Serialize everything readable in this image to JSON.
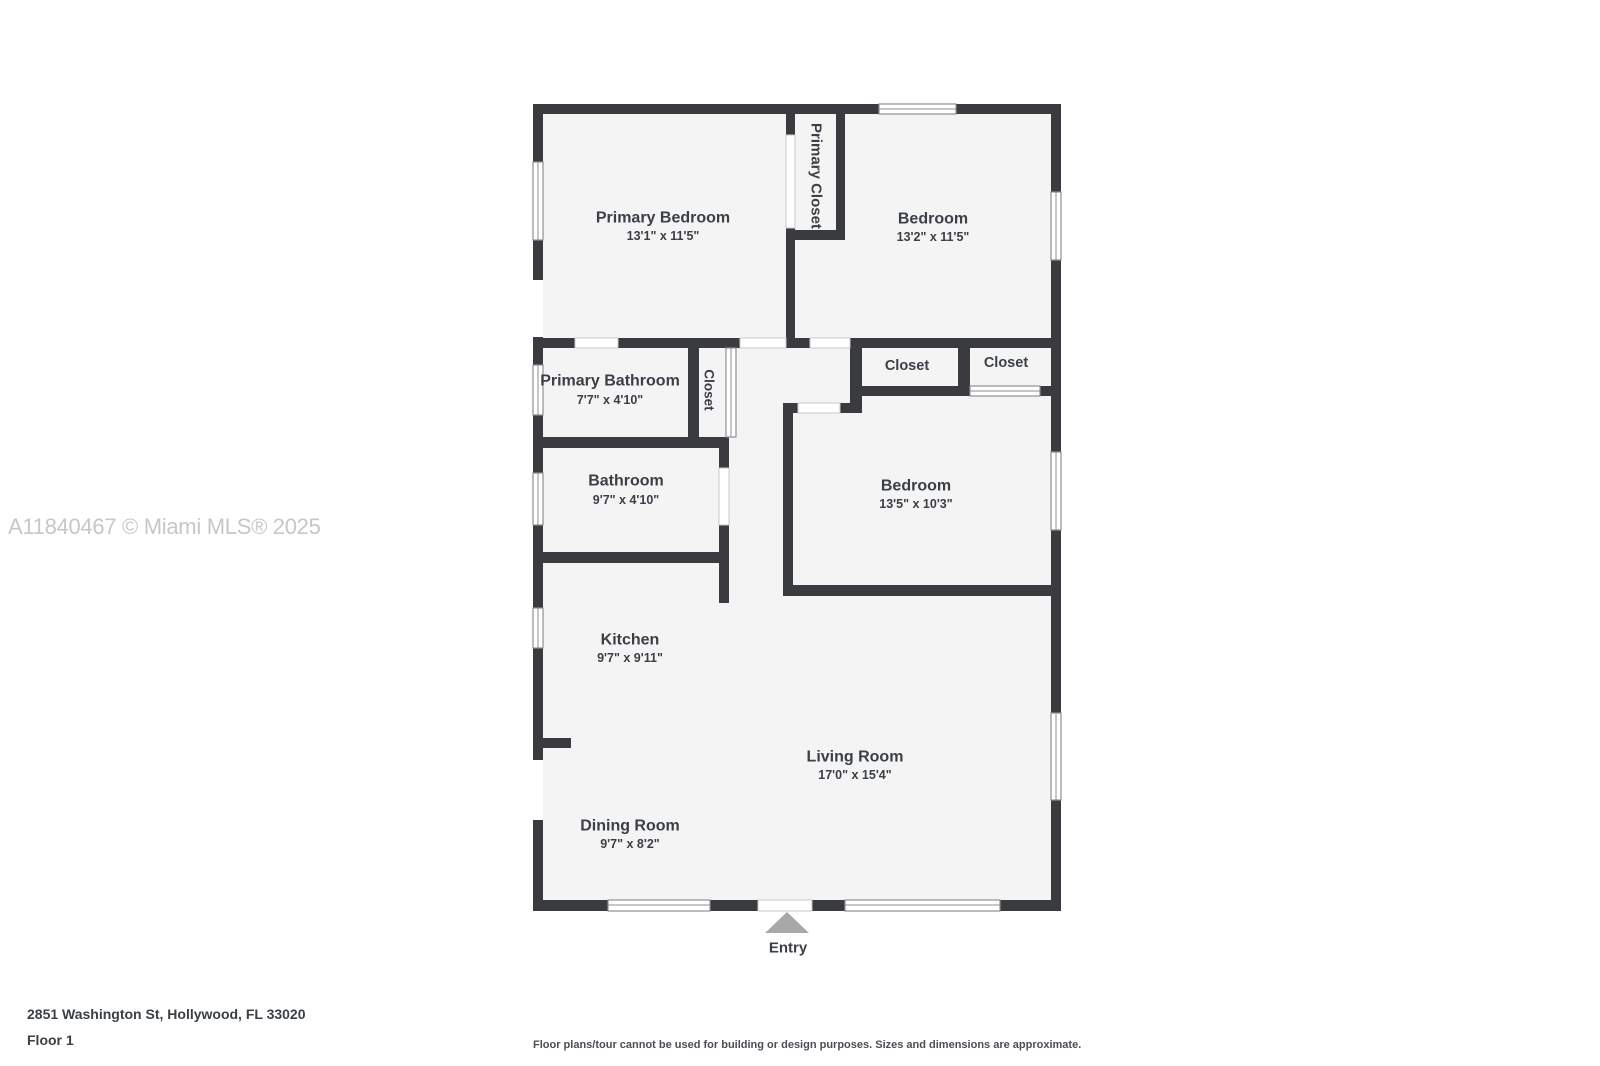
{
  "watermark": "A11840467 © Miami MLS® 2025",
  "entry_label": "Entry",
  "footer": {
    "address": "2851 Washington St, Hollywood, FL 33020",
    "floor": "Floor 1",
    "disclaimer": "Floor plans/tour cannot be used for building or design purposes. Sizes and dimensions are approximate."
  },
  "colors": {
    "wall": "#393b3e",
    "room": "#f4f4f5",
    "label": "#3b4046",
    "watermark": "#c7c7c7",
    "entryArrow": "#a8a8a8"
  },
  "rooms": [
    {
      "name": "Primary Bedroom",
      "dims": "13'1\" x 11'5\""
    },
    {
      "name": "Bedroom",
      "dims": "13'2\" x 11'5\""
    },
    {
      "name": "Primary Bathroom",
      "dims": "7'7\" x 4'10\""
    },
    {
      "name": "Bathroom",
      "dims": "9'7\" x 4'10\""
    },
    {
      "name": "Bedroom",
      "dims": "13'5\" x 10'3\""
    },
    {
      "name": "Kitchen",
      "dims": "9'7\" x 9'11\""
    },
    {
      "name": "Living Room",
      "dims": "17'0\" x 15'4\""
    },
    {
      "name": "Dining Room",
      "dims": "9'7\" x 8'2\""
    }
  ],
  "closets": [
    {
      "name": "Primary Closet"
    },
    {
      "name": "Closet"
    },
    {
      "name": "Closet"
    },
    {
      "name": "Closet"
    }
  ]
}
